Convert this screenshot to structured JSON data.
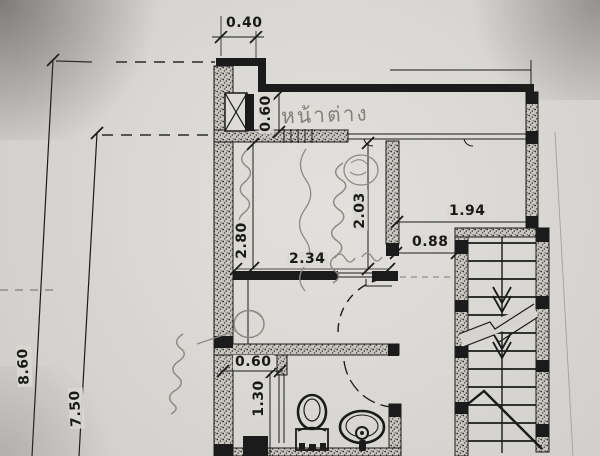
{
  "colors": {
    "paper": "#d6d4d0",
    "ink": "#1b1b1b",
    "pencil": "#8d8a84"
  },
  "annotations": {
    "window_label": "หน้าต่าง"
  },
  "dimensions": {
    "top_offset": "0.40",
    "window_strip_height": "0.60",
    "room_depth": "2.80",
    "room_width": "2.34",
    "room_inner_width": "2.03",
    "landing_width": "1.94",
    "stair_passage_width": "0.88",
    "shower_width": "0.60",
    "shower_depth": "1.30",
    "overall_depth_outer": "8.60",
    "overall_depth_inner": "7.50"
  }
}
